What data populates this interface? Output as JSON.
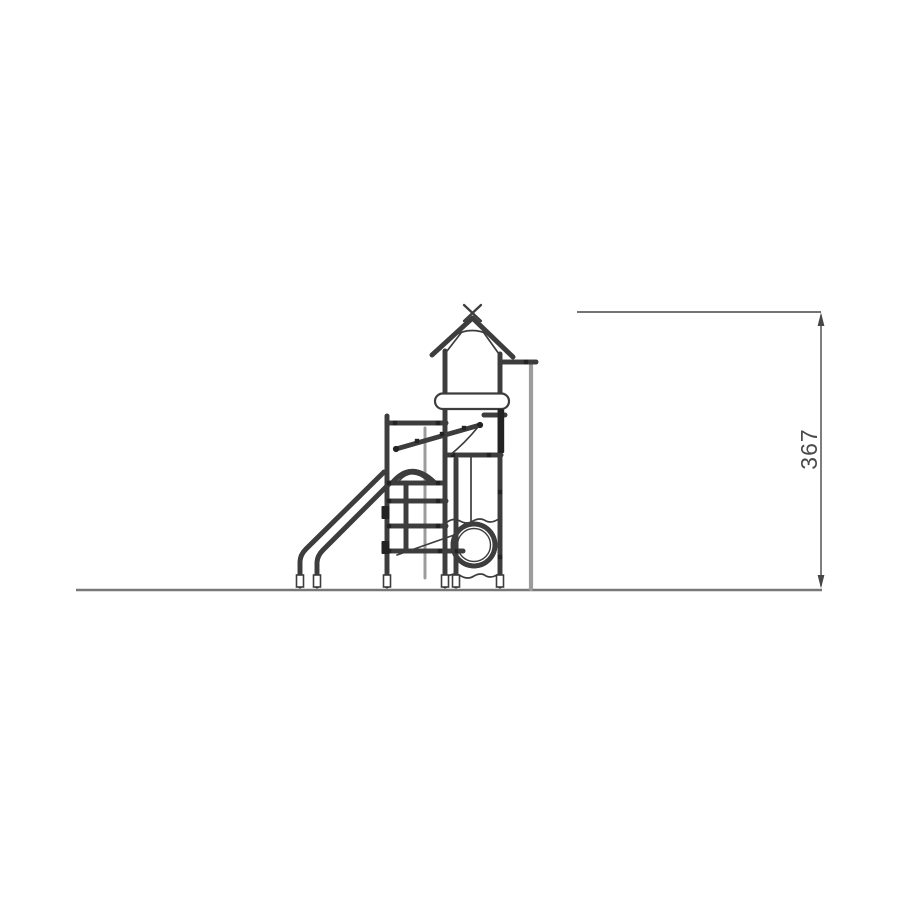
{
  "figure": {
    "name": "playground-tower-side-elevation"
  },
  "dimension": {
    "height_label": "367"
  },
  "colors": {
    "line": "#3d3d3d",
    "light_line": "#9c9c9c",
    "ground_line": "#787878",
    "dimension_line": "#474747",
    "background": "#ffffff"
  }
}
